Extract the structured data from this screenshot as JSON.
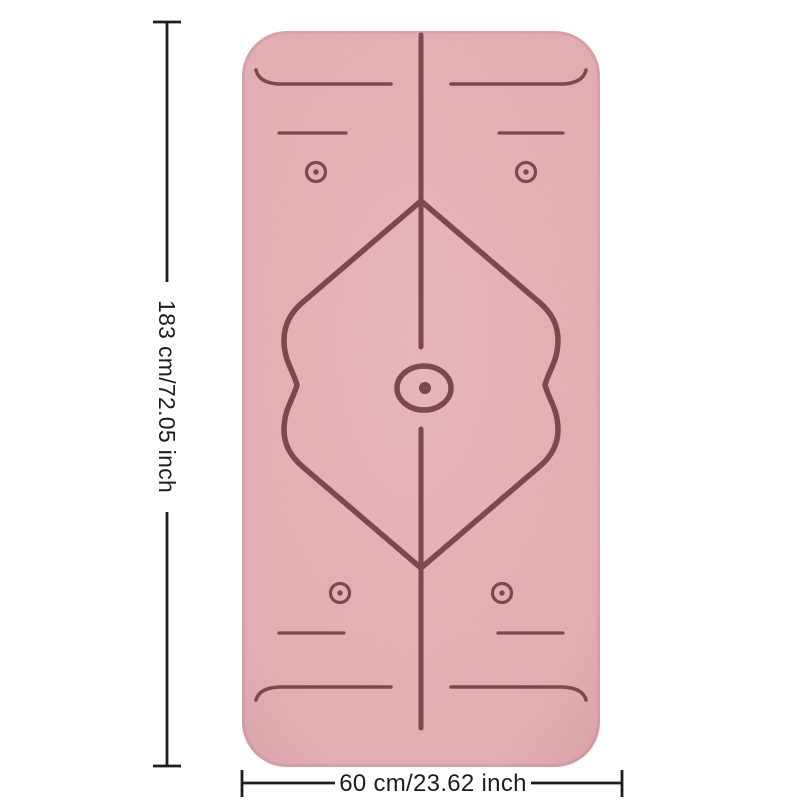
{
  "product_diagram": {
    "background_color": "#ffffff",
    "mat": {
      "surface_color": "#e4adb3",
      "guide_line_color": "#7e4850"
    },
    "annotations": {
      "text_color": "#1d1d1f",
      "height_label": "183 cm/72.05 inch",
      "width_label": "60 cm/23.62 inch"
    }
  }
}
